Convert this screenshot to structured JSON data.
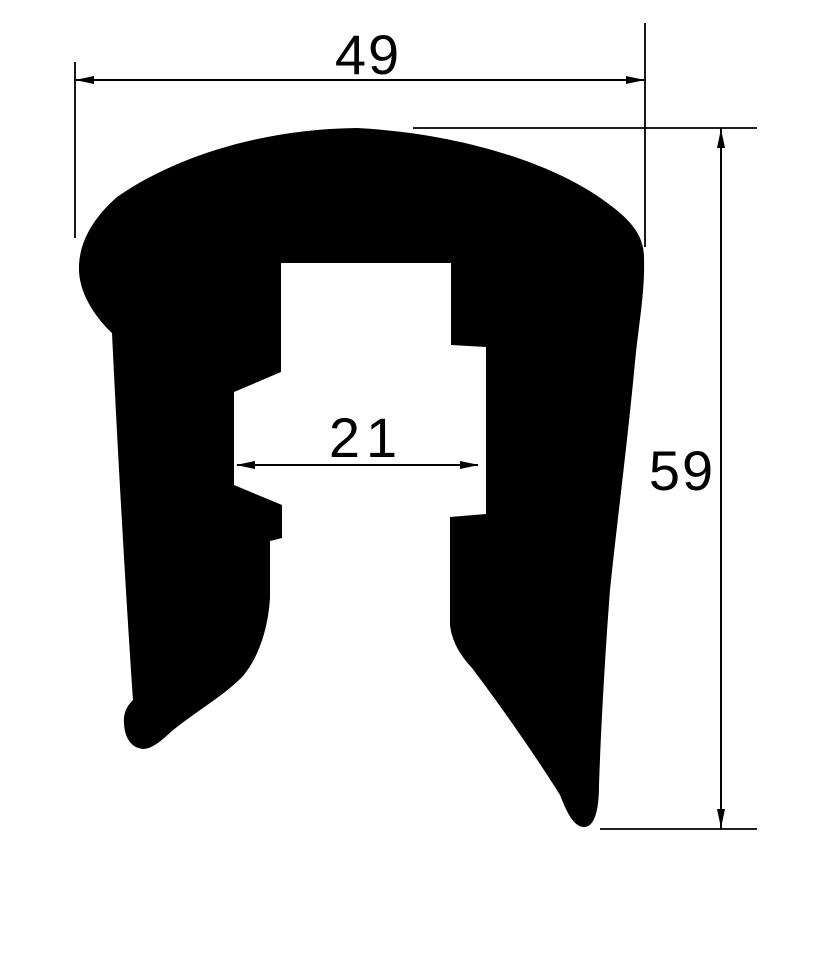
{
  "diagram": {
    "kind": "technical-drawing",
    "subject": "rubber edge trim seal profile cross-section (black silhouette with dimension lines)",
    "background_color": "#ffffff",
    "ink_color": "#000000",
    "dimensions": {
      "width": {
        "label": "49",
        "orientation": "horizontal",
        "location": "top overall width"
      },
      "inner_width": {
        "label": "21",
        "orientation": "horizontal",
        "location": "inner cavity width"
      },
      "height": {
        "label": "59",
        "orientation": "vertical",
        "location": "right overall height"
      }
    }
  }
}
